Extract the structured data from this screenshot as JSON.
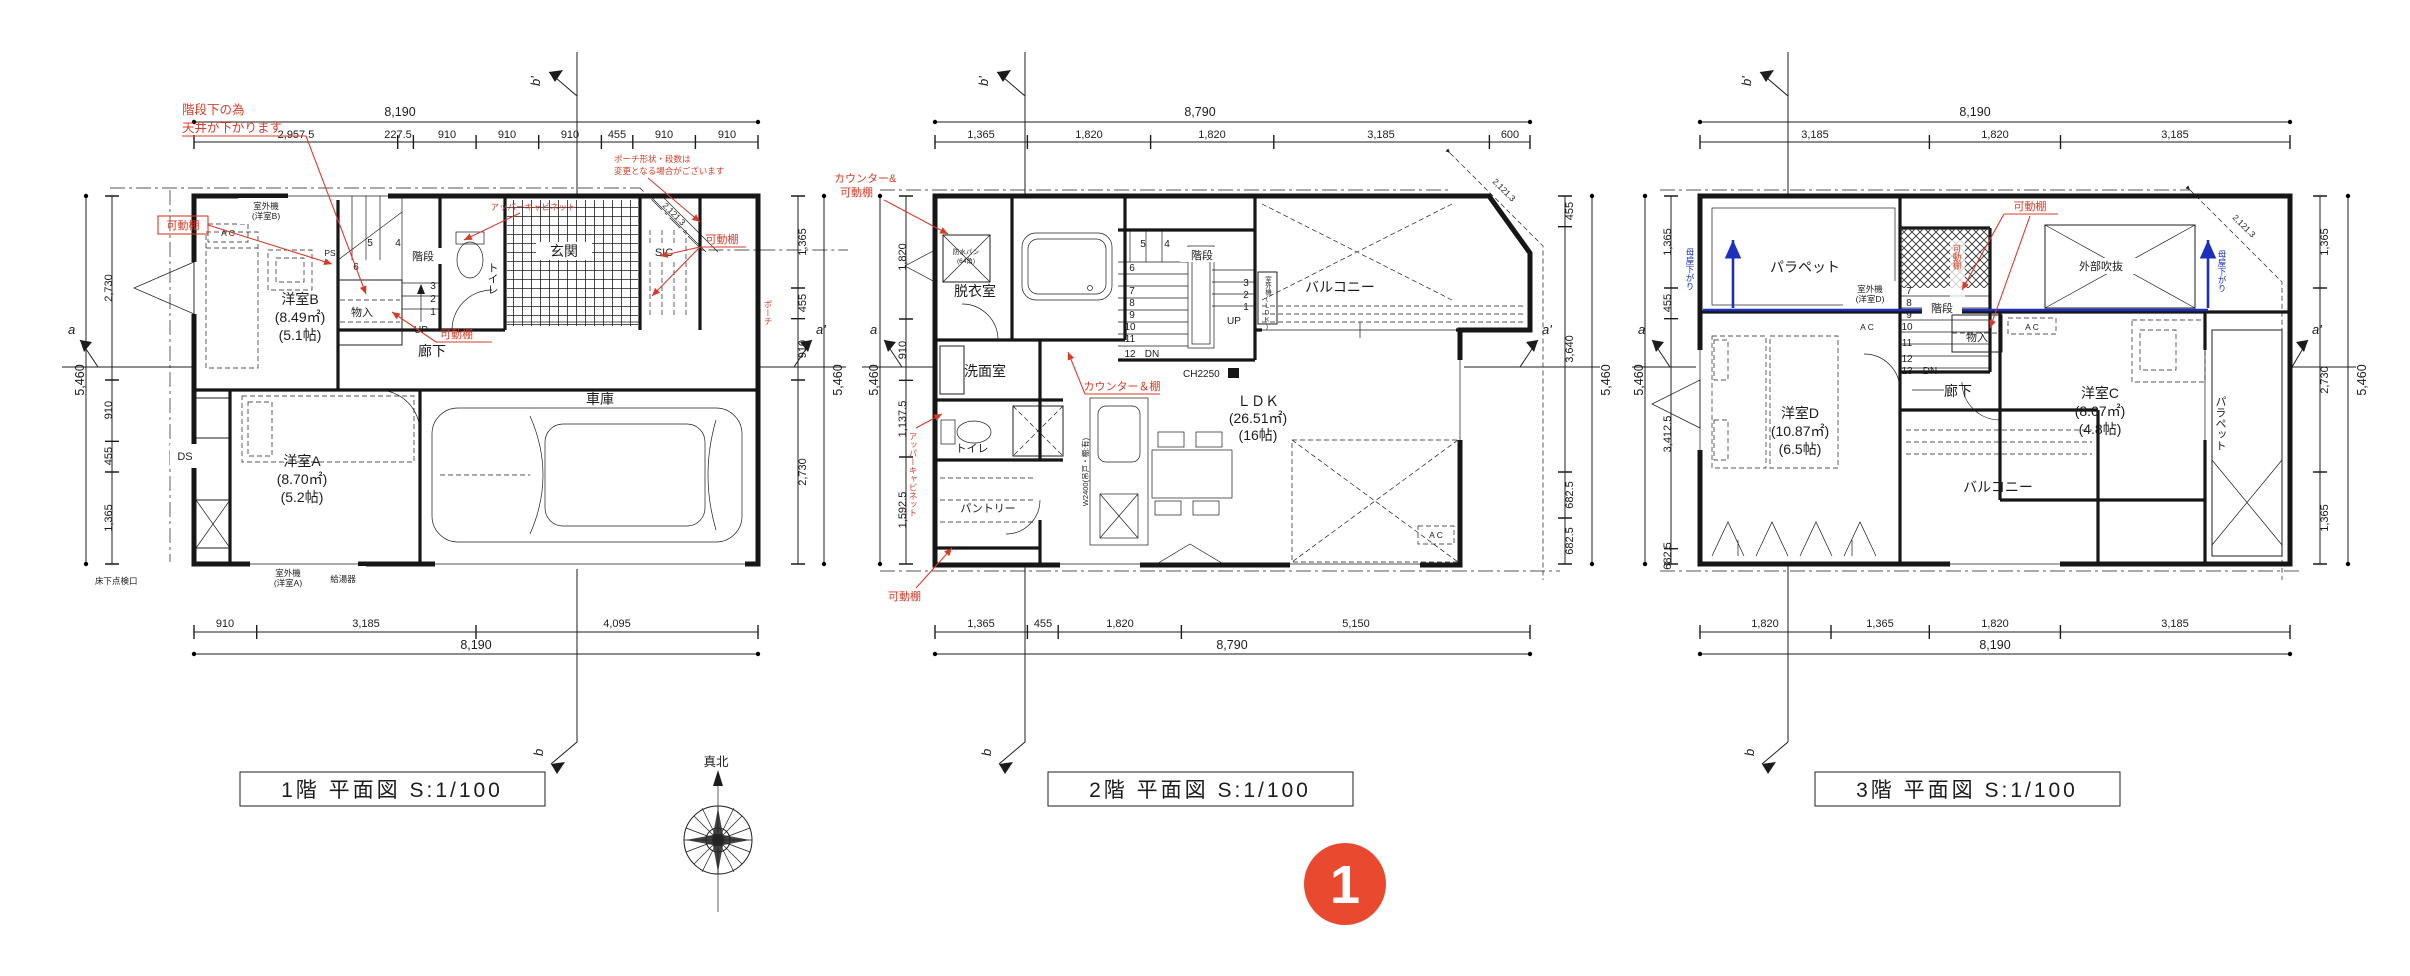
{
  "meta": {
    "badge": "1",
    "compass": "真北"
  },
  "f1": {
    "title": "1階 平面図 S:1/100",
    "markers": {
      "b_top": "b'",
      "b_bottom": "b",
      "a_left": "a",
      "a_right": "a'"
    },
    "dims": {
      "top_total": "8,190",
      "top": [
        "2,957.5",
        "227.5",
        "910",
        "910",
        "910",
        "455",
        "910",
        "910"
      ],
      "bottom": [
        "910",
        "3,185",
        "4,095"
      ],
      "bottom_total": "8,190",
      "left_total": "5,460",
      "left": [
        "2,730",
        "910",
        "455",
        "1,365"
      ],
      "right": [
        "1,365",
        "455",
        "910",
        "2,730"
      ],
      "right_total": "5,460",
      "diagonal": "2,121.3"
    },
    "rooms": {
      "room_b": "洋室B",
      "room_b_area": "(8.49㎡)",
      "room_b_tatami": "(5.1帖)",
      "room_a": "洋室A",
      "room_a_area": "(8.70㎡)",
      "room_a_tatami": "(5.2帖)",
      "garage": "車庫",
      "entrance": "玄関",
      "sic": "SIC",
      "toilet": "トイレ",
      "stairs": "階段",
      "storage": "物入",
      "hall": "廊下",
      "ds": "DS",
      "ps": "PS"
    },
    "fixtures": {
      "ac": "A C",
      "outdoor_b1": "室外機",
      "outdoor_b2": "(洋室B)",
      "outdoor_a1": "室外機",
      "outdoor_a2": "(洋室A)",
      "water_heater": "給湯器",
      "underfloor_hatch": "床下点検口"
    },
    "stairs": {
      "steps": [
        "1",
        "2",
        "3",
        "4",
        "5",
        "6"
      ],
      "up": "UP"
    },
    "notes": {
      "ceiling1": "階段下の為",
      "ceiling2": "天井が下がります",
      "movable_shelf": "可動棚",
      "upper_cabinet": "アッパーキャビネット",
      "porch1": "ポーチ形状・段数は",
      "porch2": "変更となる場合がございます",
      "porch": "ポーチ"
    }
  },
  "f2": {
    "title": "2階 平面図 S:1/100",
    "markers": {
      "b_top": "b'",
      "b_bottom": "b",
      "a_left": "a",
      "a_right": "a'"
    },
    "dims": {
      "top_total": "8,790",
      "top": [
        "1,365",
        "1,820",
        "1,820",
        "3,185",
        "600"
      ],
      "bottom": [
        "1,365",
        "455",
        "1,820",
        "5,150"
      ],
      "bottom_total": "8,790",
      "left_total": "5,460",
      "left": [
        "1,820",
        "910",
        "1,137.5",
        "1,592.5"
      ],
      "right": [
        "455",
        "3,640",
        "682.5",
        "682.5"
      ],
      "right_total": "5,460",
      "diagonal": "2,121.3"
    },
    "rooms": {
      "dressing": "脱衣室",
      "washroom": "洗面室",
      "toilet": "トイレ",
      "pantry": "パントリー",
      "stairs": "階段",
      "balcony": "バルコニー",
      "ldk": "ＬＤＫ",
      "ldk_area": "(26.51㎡)",
      "ldk_tatami": "(16帖)"
    },
    "fixtures": {
      "ch": "CH2250",
      "ac": "A C",
      "kitchen": "W2400(吊戸・棚:有)",
      "pan1": "防水パン",
      "pan2": "(64角)",
      "outdoor_ldk": "室外機(LDK)"
    },
    "stairs": {
      "steps": [
        "1",
        "2",
        "3",
        "4",
        "5",
        "6",
        "7",
        "8",
        "9",
        "10",
        "11",
        "12"
      ],
      "up": "UP",
      "dn": "DN"
    },
    "notes": {
      "counter1": "カウンター&",
      "counter2": "可動棚",
      "counter_shelf": "カウンター＆棚",
      "upper_cabinet": "アッパーキャビネット",
      "movable_shelf": "可動棚"
    }
  },
  "f3": {
    "title": "3階 平面図 S:1/100",
    "markers": {
      "b_top": "b'",
      "b_bottom": "b",
      "a_left": "a",
      "a_right": "a'"
    },
    "dims": {
      "top_total": "8,190",
      "top": [
        "3,185",
        "1,820",
        "3,185"
      ],
      "bottom": [
        "1,820",
        "1,365",
        "1,820",
        "3,185"
      ],
      "bottom_total": "8,190",
      "left_total": "5,460",
      "left": [
        "1,365",
        "455",
        "3,412.5",
        "682.5"
      ],
      "right": [
        "1,365",
        "2,730",
        "1,365"
      ],
      "right_total": "5,460",
      "diagonal": "2,121.3"
    },
    "rooms": {
      "parapet": "パラペット",
      "parapet_right": "パラペット",
      "outer_void": "外部吹抜",
      "room_d": "洋室D",
      "room_d_area": "(10.87㎡)",
      "room_d_tatami": "(6.5帖)",
      "room_c": "洋室C",
      "room_c_area": "(8.07㎡)",
      "room_c_tatami": "(4.8帖)",
      "balcony": "バルコニー",
      "hall": "廊下",
      "storage": "物入",
      "stairs": "階段"
    },
    "fixtures": {
      "outdoor_d1": "室外機",
      "outdoor_d2": "(洋室D)",
      "ac": "A C"
    },
    "stairs": {
      "steps": [
        "7",
        "8",
        "9",
        "10",
        "11",
        "12",
        "13"
      ],
      "dn": "DN"
    },
    "notes": {
      "movable_shelf": "可動棚",
      "movable_shelf_v": "可動棚",
      "roof_lowered": "母屋下がり"
    }
  }
}
